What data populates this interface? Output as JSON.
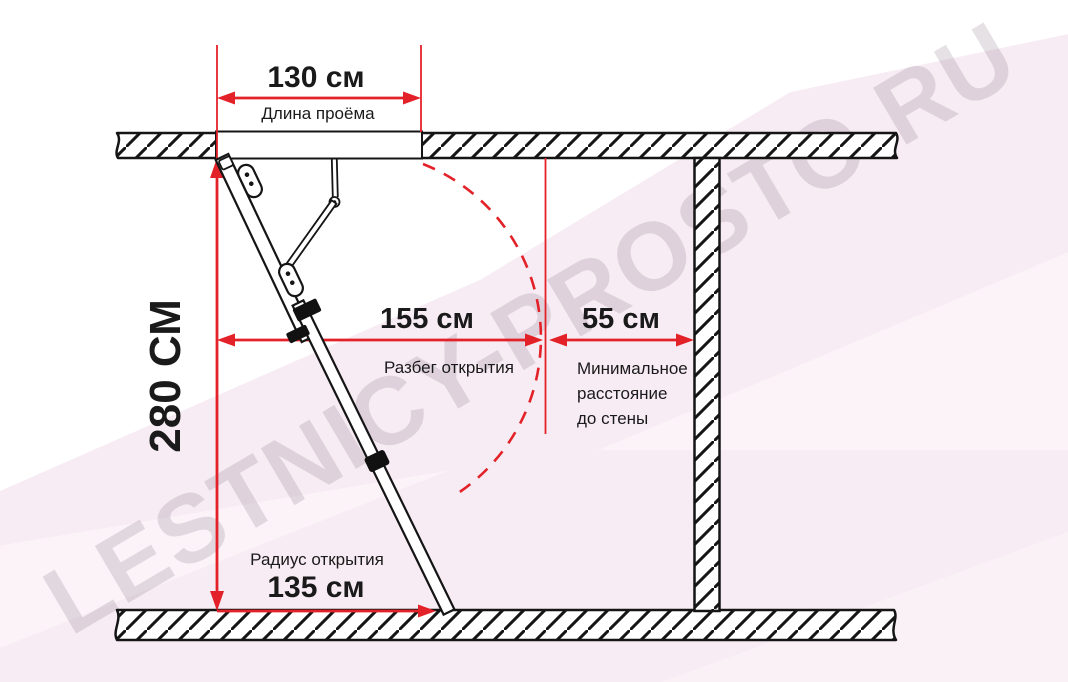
{
  "watermark": "LESTNICY-PROSTO.RU",
  "colors": {
    "dimension_red": "#e32128",
    "line_black": "#151515",
    "text_black": "#1a1a1a",
    "background_pink": "#f7ecf3"
  },
  "dimensions": {
    "opening_length": {
      "value": "130 см",
      "label": "Длина проёма"
    },
    "ceiling_height": {
      "value": "280 СМ"
    },
    "opening_run": {
      "value": "155 см",
      "label": "Разбег открытия"
    },
    "wall_clearance": {
      "value": "55 см",
      "lines": [
        "Минимальное",
        "расстояние",
        "до стены"
      ]
    },
    "opening_radius": {
      "value": "135 см",
      "label": "Радиус открытия"
    }
  }
}
